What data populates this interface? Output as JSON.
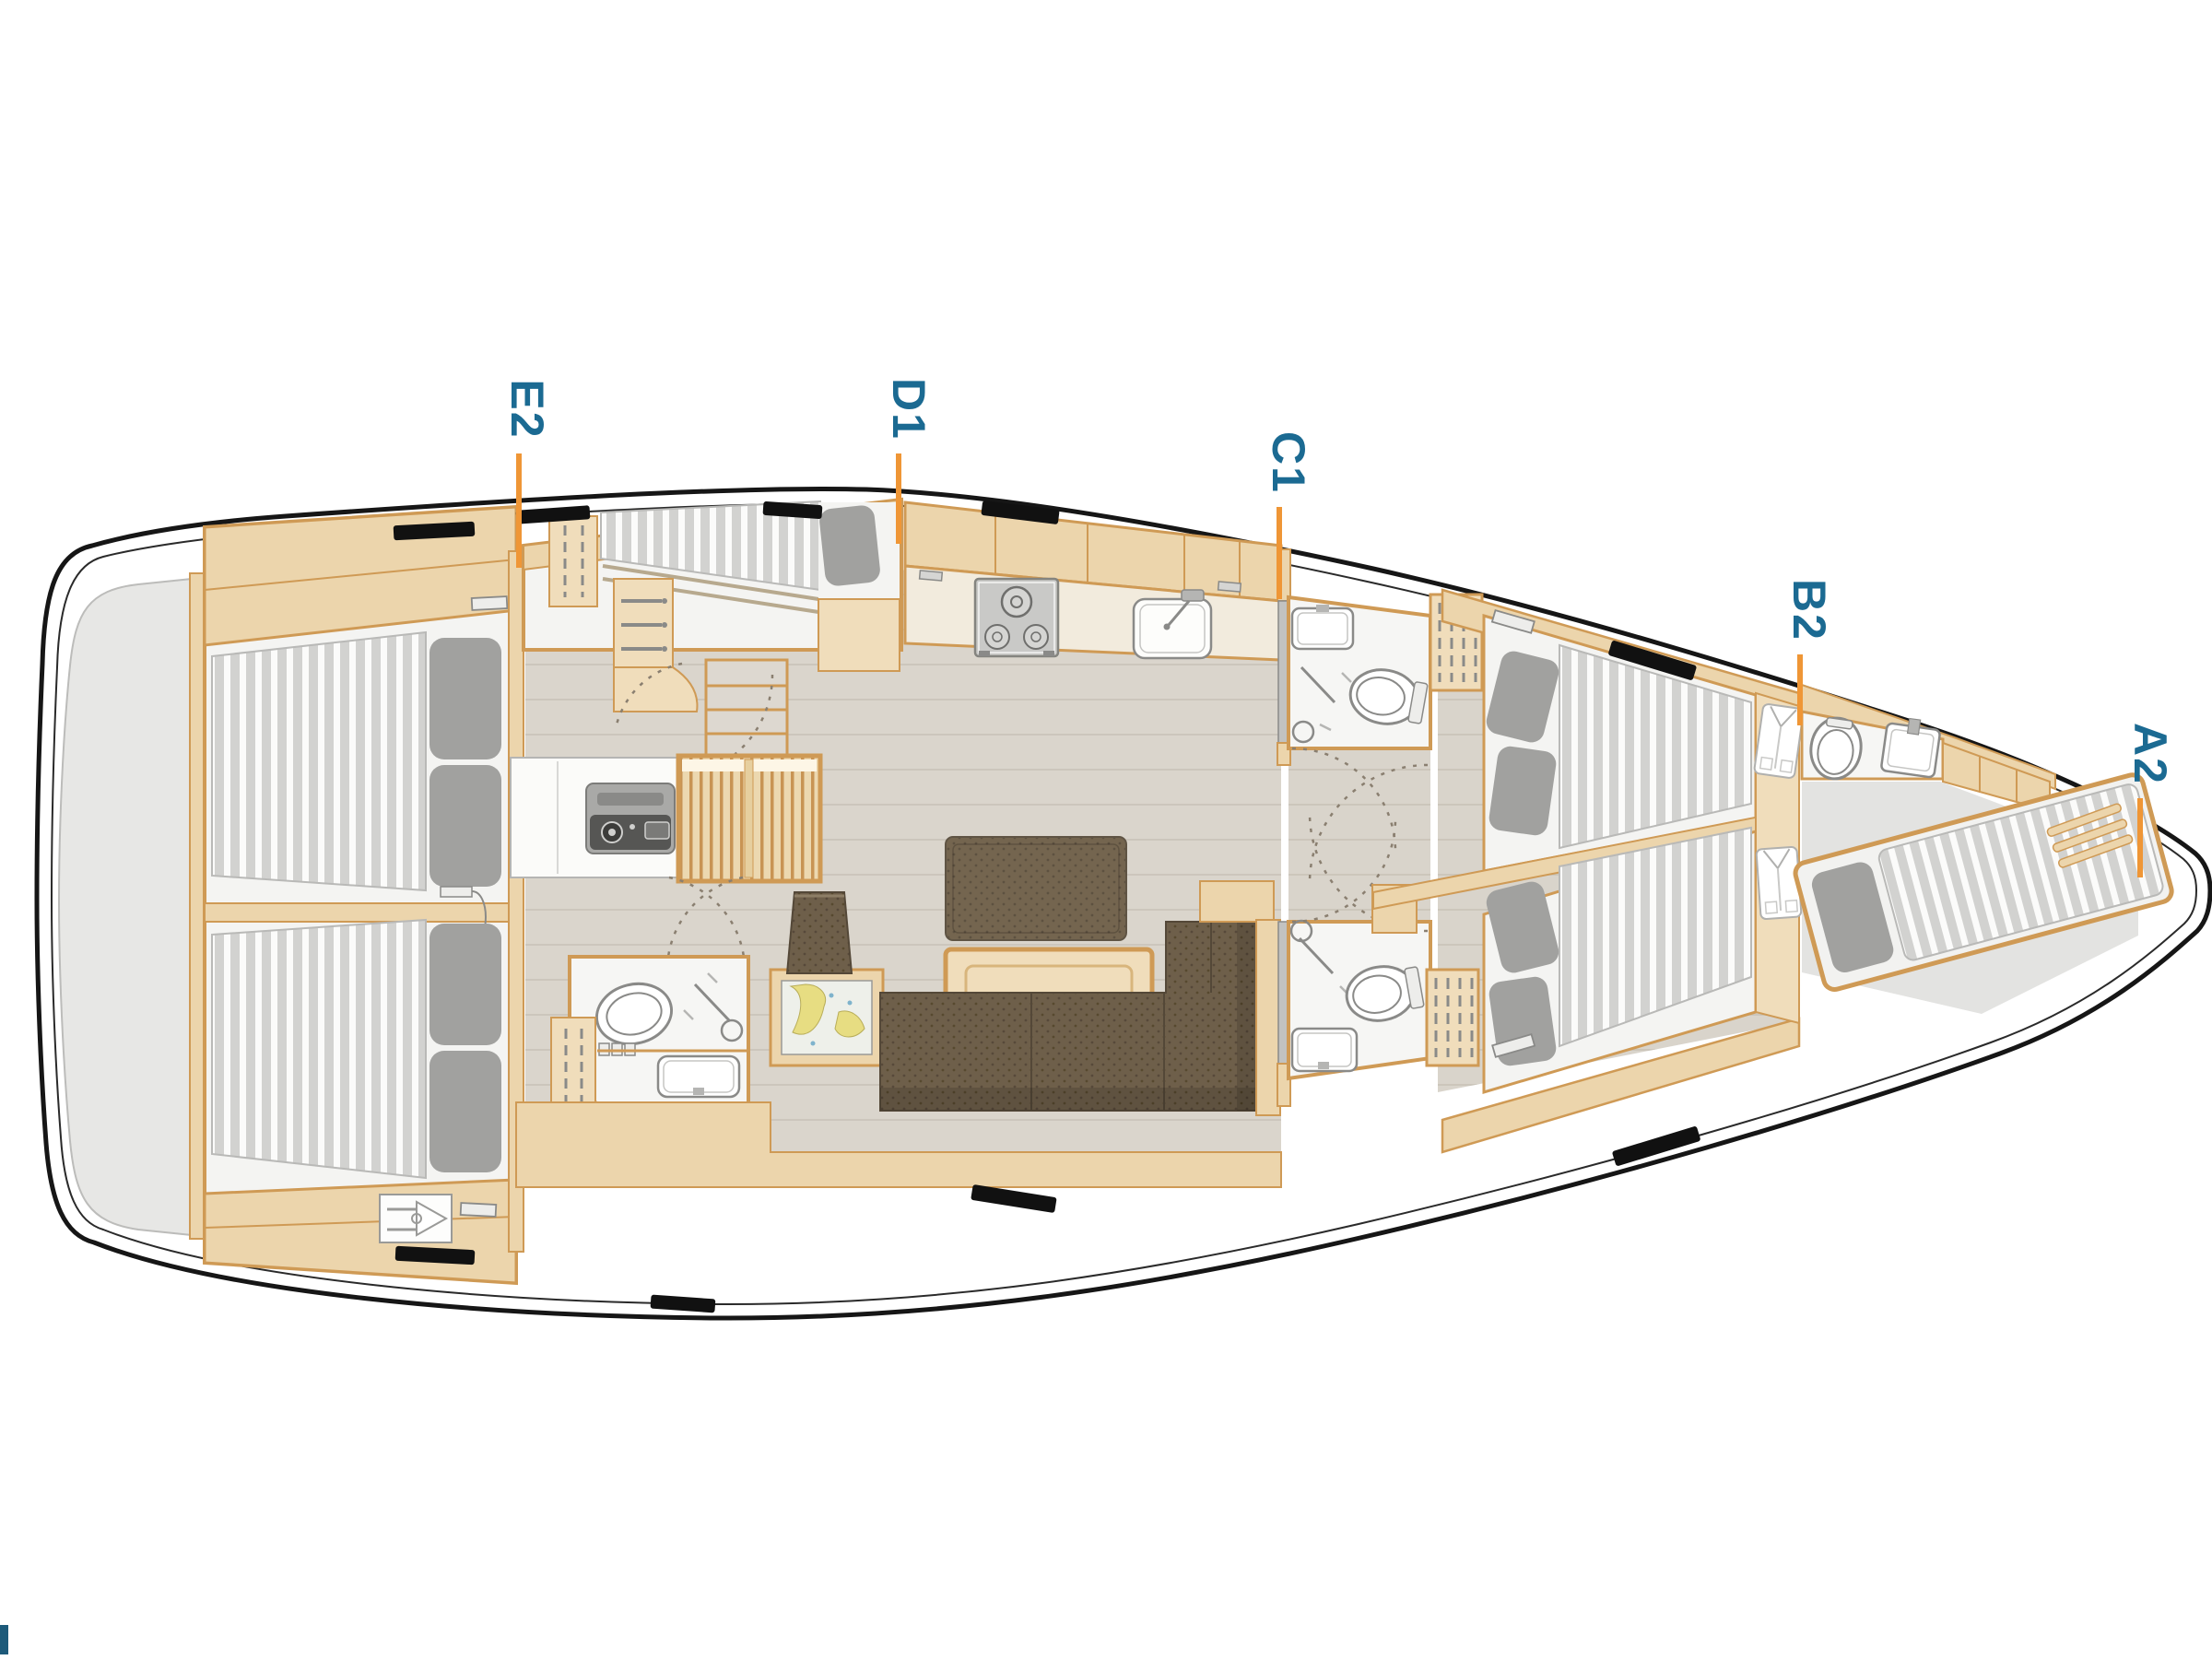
{
  "diagram": {
    "type": "yacht-interior-floorplan",
    "orientation": "bow-right",
    "labels": [
      {
        "id": "E2",
        "text": "E2",
        "points_to": "aft-port-cabin"
      },
      {
        "id": "D1",
        "text": "D1",
        "points_to": "single-berth-cabin"
      },
      {
        "id": "C1",
        "text": "C1",
        "points_to": "mid-head-port"
      },
      {
        "id": "B2",
        "text": "B2",
        "points_to": "forward-head"
      },
      {
        "id": "A2",
        "text": "A2",
        "points_to": "bow-cabin"
      }
    ],
    "colors": {
      "label_text": "#1b6a92",
      "leader_line": "#ef9636",
      "hull_line": "#161616",
      "wood": "#f0ddbb",
      "wood_band": "#ecd5ac",
      "wood_border": "#cf9a55",
      "floor": "#dad5cc",
      "room_white": "#f4f4f2",
      "mattress": "#d2d2d0",
      "pillow": "#a1a19f",
      "leather_dark": "#6e5f4a",
      "platform_gray": "#e7e7e5",
      "fixture_outline": "#8a8a88",
      "map_land": "#e7dd82"
    },
    "icons": [
      "toilet-icon",
      "shower-icon",
      "sink-icon",
      "stove-icon",
      "double-bed-icon",
      "single-bed-icon",
      "pillow-icon",
      "hanging-locker-icon",
      "drawers-icon",
      "shirt-locker-icon",
      "chart-table-icon",
      "appliance-icon",
      "steering-gear-icon",
      "deck-window-icon",
      "door-swing-icon",
      "louver-vent-icon"
    ]
  },
  "footer": {
    "logo_mark": "clipped-blue-logo"
  }
}
